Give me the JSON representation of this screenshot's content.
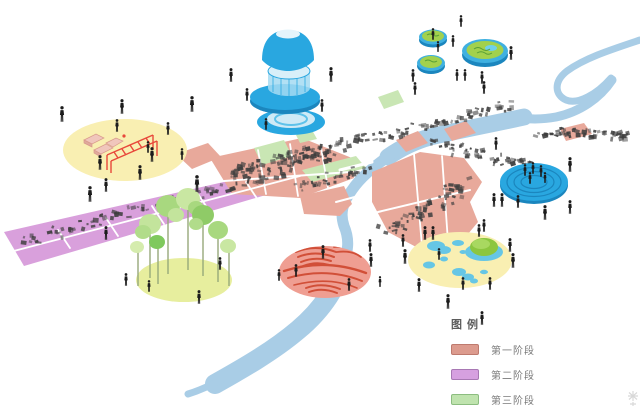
{
  "legend": {
    "title": "图例",
    "items": [
      {
        "label": "第一阶段",
        "color": "#DC9B8E",
        "border": "#BE7A6E"
      },
      {
        "label": "第二阶段",
        "color": "#D6A0E0",
        "border": "#A878B4"
      },
      {
        "label": "第三阶段",
        "color": "#BFE3AE",
        "border": "#8CBD80"
      }
    ]
  },
  "palette": {
    "river": "#A9CDE6",
    "phase1_zone": "#E8A99B",
    "phase2_zone": "#D9A0DC",
    "phase3_zone": "#C9E6B4",
    "highlight_yellow": "#F9EFB2",
    "grove_yellow": "#E7EE9E",
    "accent_blue": "#29A7E0",
    "accent_blue_dark": "#1B86BE",
    "accent_blue_pale": "#CFEAF6",
    "water_blue": "#66C6E5",
    "salmon_circle": "#EF9E92",
    "wave_red": "#D14F38",
    "island_green": "#A2D14D",
    "mound_green": "#8CC63F",
    "play_red": "#E8483B",
    "block_pink": "#F0C6BC",
    "building_gray": "#3E3E3E",
    "person_black": "#1C1C1C",
    "street_white": "#FFFFFF"
  },
  "scene": {
    "people": [
      [
        62,
        122,
        16
      ],
      [
        122,
        114,
        15
      ],
      [
        192,
        112,
        16
      ],
      [
        100,
        170,
        15
      ],
      [
        90,
        202,
        16
      ],
      [
        140,
        180,
        15
      ],
      [
        152,
        162,
        15
      ],
      [
        117,
        132,
        13
      ],
      [
        168,
        135,
        13
      ],
      [
        182,
        160,
        12
      ],
      [
        197,
        192,
        17
      ],
      [
        106,
        192,
        14
      ],
      [
        148,
        153,
        12
      ],
      [
        231,
        82,
        14
      ],
      [
        247,
        101,
        13
      ],
      [
        331,
        82,
        15
      ],
      [
        322,
        112,
        13
      ],
      [
        266,
        130,
        12
      ],
      [
        433,
        40,
        12
      ],
      [
        438,
        52,
        11
      ],
      [
        453,
        47,
        12
      ],
      [
        461,
        27,
        12
      ],
      [
        511,
        60,
        14
      ],
      [
        482,
        84,
        13
      ],
      [
        413,
        82,
        13
      ],
      [
        457,
        81,
        12
      ],
      [
        465,
        81,
        12
      ],
      [
        415,
        95,
        13
      ],
      [
        484,
        94,
        13
      ],
      [
        496,
        150,
        13
      ],
      [
        570,
        172,
        15
      ],
      [
        494,
        207,
        14
      ],
      [
        502,
        207,
        14
      ],
      [
        518,
        208,
        13
      ],
      [
        545,
        220,
        15
      ],
      [
        570,
        214,
        14
      ],
      [
        484,
        232,
        13
      ],
      [
        510,
        252,
        14
      ],
      [
        525,
        176,
        12
      ],
      [
        533,
        174,
        12
      ],
      [
        541,
        177,
        12
      ],
      [
        530,
        184,
        12
      ],
      [
        545,
        183,
        11
      ],
      [
        425,
        240,
        14
      ],
      [
        433,
        240,
        14
      ],
      [
        479,
        237,
        13
      ],
      [
        405,
        264,
        15
      ],
      [
        513,
        268,
        15
      ],
      [
        439,
        260,
        12
      ],
      [
        463,
        290,
        13
      ],
      [
        490,
        290,
        13
      ],
      [
        419,
        292,
        14
      ],
      [
        448,
        309,
        15
      ],
      [
        482,
        325,
        14
      ],
      [
        323,
        259,
        14
      ],
      [
        296,
        277,
        13
      ],
      [
        279,
        281,
        12
      ],
      [
        349,
        291,
        13
      ],
      [
        371,
        267,
        14
      ],
      [
        380,
        287,
        11
      ],
      [
        126,
        286,
        13
      ],
      [
        149,
        292,
        12
      ],
      [
        199,
        304,
        14
      ],
      [
        220,
        270,
        13
      ],
      [
        106,
        240,
        14
      ],
      [
        370,
        252,
        13
      ],
      [
        403,
        247,
        13
      ]
    ],
    "building_strips": [
      {
        "x1": 20,
        "y1": 240,
        "x2": 290,
        "y2": 168,
        "n": 85,
        "spread": 7
      },
      {
        "x1": 225,
        "y1": 172,
        "x2": 333,
        "y2": 149,
        "n": 60,
        "spread": 11
      },
      {
        "x1": 298,
        "y1": 186,
        "x2": 366,
        "y2": 167,
        "n": 32,
        "spread": 8
      },
      {
        "x1": 276,
        "y1": 158,
        "x2": 512,
        "y2": 104,
        "n": 100,
        "spread": 8
      },
      {
        "x1": 432,
        "y1": 141,
        "x2": 530,
        "y2": 166,
        "n": 48,
        "spread": 8
      },
      {
        "x1": 535,
        "y1": 130,
        "x2": 630,
        "y2": 134,
        "n": 48,
        "spread": 6
      },
      {
        "x1": 388,
        "y1": 230,
        "x2": 468,
        "y2": 182,
        "n": 58,
        "spread": 11
      }
    ]
  }
}
